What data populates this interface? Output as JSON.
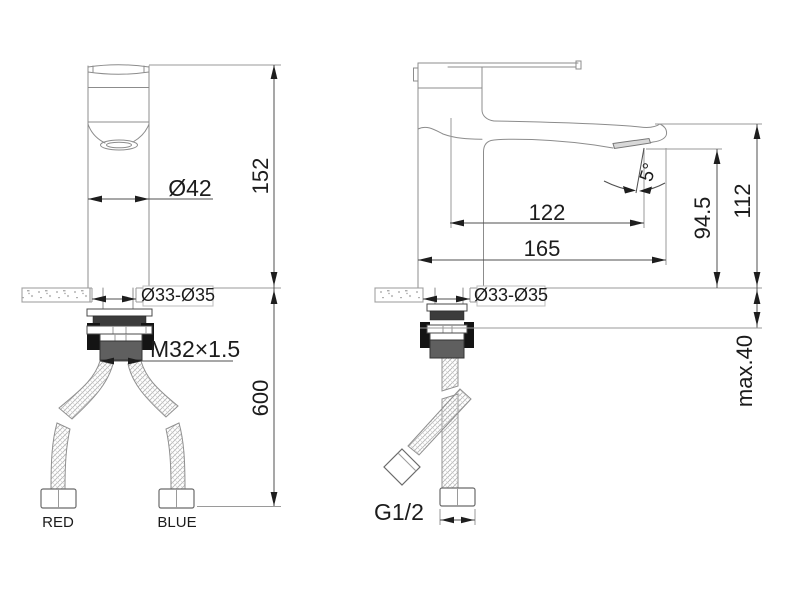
{
  "drawing": {
    "front_view": {
      "diameter": "Ø42",
      "height": "152",
      "hole": "Ø33-Ø35",
      "thread": "M32×1.5",
      "hose_length": "600",
      "hot_label": "RED",
      "cold_label": "BLUE"
    },
    "side_view": {
      "spout_reach": "122",
      "depth": "165",
      "spout_height": "94.5",
      "height": "112",
      "angle": "5°",
      "hole": "Ø33-Ø35",
      "max_deck": "max.40",
      "connection": "G1/2"
    },
    "colors": {
      "outline": "#8c8c8c",
      "dimension": "#4f4f4f",
      "text": "#1c1c1c",
      "hardware_dark": "#3c3c3c",
      "hardware_gray": "#5f5f5f"
    }
  }
}
